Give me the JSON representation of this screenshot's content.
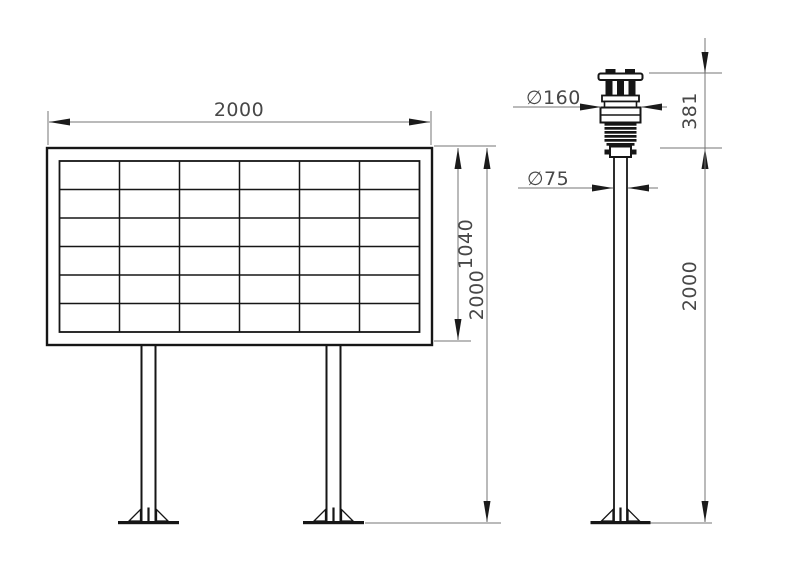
{
  "colors": {
    "background": "#ffffff",
    "object_line": "#161616",
    "dimension_line": "#747474",
    "dimension_text": "#474747",
    "arrow": "#1b1b1b"
  },
  "display_board": {
    "grid_rows": 6,
    "grid_cols": 6,
    "width_label": "2000",
    "panel_height_label": "1040",
    "total_height_label": "2000"
  },
  "weather_station": {
    "sensor_diameter_label": "∅160",
    "pole_diameter_label": "∅75",
    "sensor_height_label": "381",
    "pole_height_label": "2000"
  }
}
